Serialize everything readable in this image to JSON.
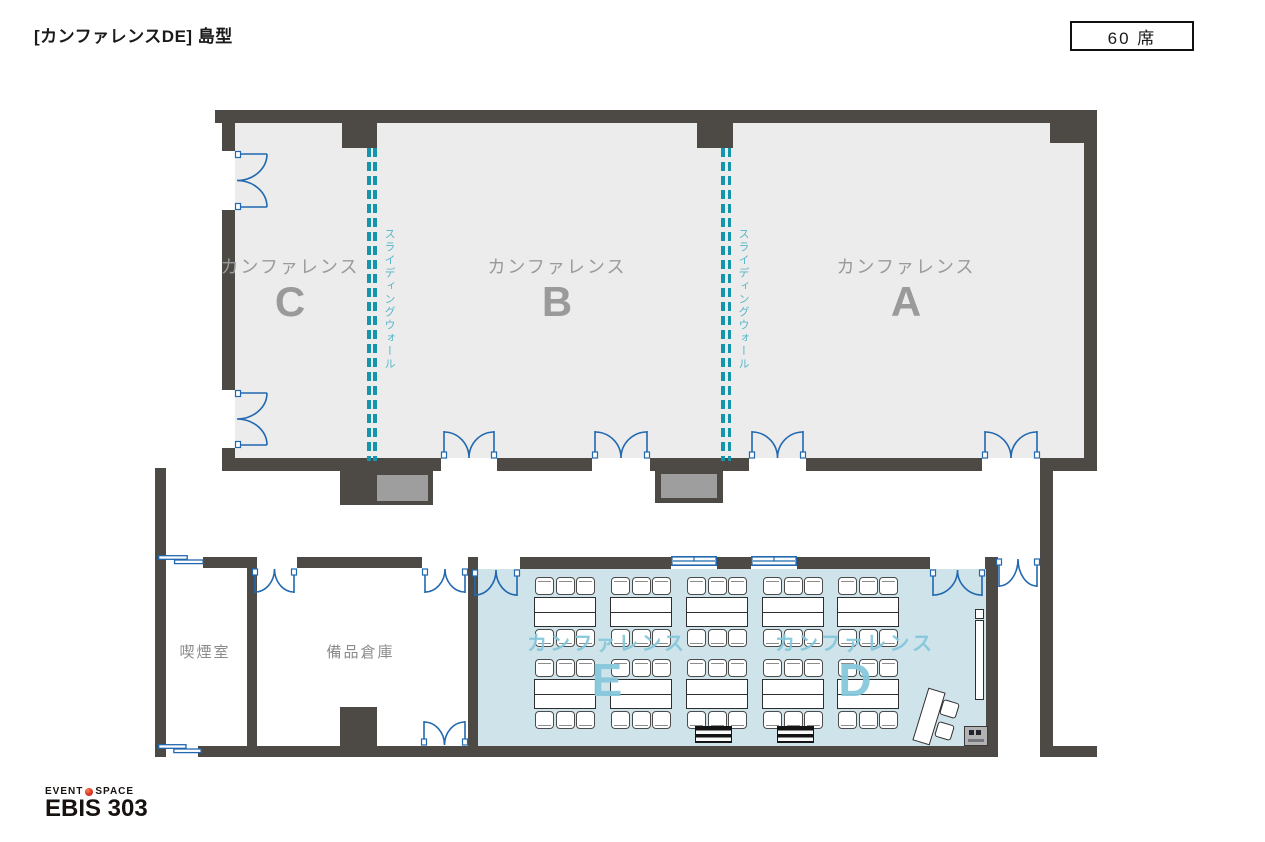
{
  "header": {
    "title": "[カンファレンスDE] 島型",
    "capacity": "60 席"
  },
  "rooms": {
    "a": {
      "label": "カンファレンス",
      "letter": "A"
    },
    "b": {
      "label": "カンファレンス",
      "letter": "B"
    },
    "c": {
      "label": "カンファレンス",
      "letter": "C"
    },
    "d": {
      "label": "カンファレンス",
      "letter": "D"
    },
    "e": {
      "label": "カンファレンス",
      "letter": "E"
    },
    "smoking": {
      "label": "喫煙室"
    },
    "storage": {
      "label": "備品倉庫"
    }
  },
  "annotations": {
    "sliding_wall": "スライディングウォール"
  },
  "seating": {
    "layout_name": "島型",
    "total_seats": 60,
    "island_columns": 5,
    "island_rows": 2,
    "seats_per_island": 6
  },
  "logo": {
    "line1_left": "EVENT",
    "line1_right": "SPACE",
    "line2": "EBIS 303"
  },
  "colors": {
    "wall": "#4d4945",
    "room_fill": "#ececec",
    "highlight_fill": "#cfe4ea",
    "door": "#2268b0",
    "sliding_wall": "#1495ab",
    "sliding_wall_text": "#55b5c8",
    "label_gray": "#9a9a9a",
    "logo_red": "#d4311e"
  }
}
